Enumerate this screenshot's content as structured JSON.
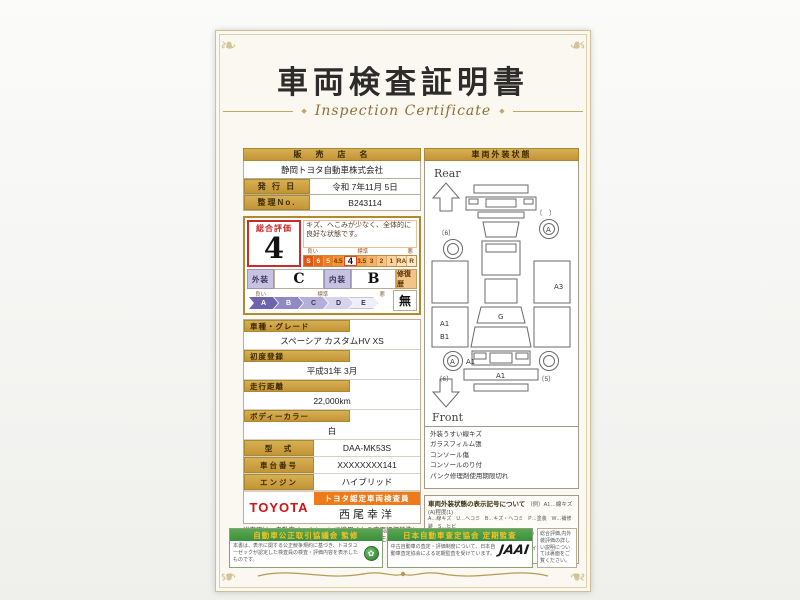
{
  "page": {
    "title": "車両検査証明書",
    "subtitle": "Inspection Certificate"
  },
  "dealer": {
    "label": "販　売　店　名",
    "value": "静岡トヨタ自動車株式会社"
  },
  "issue_date": {
    "label": "発 行 日",
    "value": "令和 7年11月 5日"
  },
  "ref_no": {
    "label": "整理No.",
    "value": "B243114"
  },
  "evaluation": {
    "overall_label": "総合評価",
    "overall_score": "4",
    "comment": "キズ、へこみが少なく、全体的に良好な状態です。",
    "scale_good": "良い",
    "scale_std": "標準",
    "scale_bad": "悪",
    "scale_cells": [
      "S",
      "6",
      "5",
      "4.5",
      "4",
      "3.5",
      "3",
      "2",
      "1",
      "RA",
      "R"
    ],
    "exterior_label": "外装",
    "exterior_value": "C",
    "interior_label": "内装",
    "interior_value": "B",
    "repair_label": "修復歴",
    "repair_value": "無",
    "grade_good": "良い",
    "grade_std": "標準",
    "grade_bad": "悪",
    "grade_cells": [
      "A",
      "B",
      "C",
      "D",
      "E"
    ]
  },
  "fields": [
    {
      "label": "車種・グレード",
      "value": "スペーシア カスタムHV XS"
    },
    {
      "label": "初度登録",
      "value": "平成31年 3月"
    },
    {
      "label": "走行距離",
      "value": "22,000km"
    },
    {
      "label": "ボディーカラー",
      "value": "白"
    },
    {
      "label": "型　式",
      "value": "DAA-MK53S"
    },
    {
      "label": "車台番号",
      "value": "XXXXXXXX141"
    },
    {
      "label": "エンジン",
      "value": "ハイブリッド"
    }
  ],
  "inspector": {
    "brand": "TOYOTA",
    "badge": "トヨタ認定車両検査員",
    "name": "西尾幸洋"
  },
  "disclaimer": "当車両は、自動車オークションで適用される車両評価基準に沿い、トヨタユーゼックが認定した検査員が厳正に検査・評価いたしました。",
  "diagram": {
    "header": "車両外装状態",
    "rear_label": "Rear",
    "front_label": "Front",
    "marks": {
      "left_a1": "A1",
      "left_b1": "B1",
      "wheel_a_right": "A",
      "wheel_a_left": "A",
      "wheel_note": "A1",
      "right_a3": "A3",
      "center_g": "G",
      "front_a1": "A1",
      "tire_tl": "〔6〕",
      "tire_tr": "〔　〕",
      "tire_bl": "〔6〕",
      "tire_br": "〔5〕"
    },
    "notes": [
      "外装うすい線キズ",
      "ガラスフィルム張",
      "コンソール傷",
      "コンソールのり付",
      "パンク修理剤使用期限切れ"
    ]
  },
  "legend": {
    "title": "車両外装状態の表示記号について",
    "example": "（例）A1…線キズ(A)程度(1)",
    "lines": [
      "A…線キズ　U…ヘコミ　B…キズ・ヘコミ　P…塗装　W…補修跡　S…ヒビ",
      "C…腐食汚れ　G…フロントガラス(飛び石キズ)　X…要交換　XX…交換済",
      "1…小程度　2…中程度　3…大程度以上　ドライヤ等の表示は取り外してあります。"
    ]
  },
  "footer": {
    "fair_trade": {
      "header": "自動車公正取引協議会 監修",
      "text": "本書は、表示に関する公正競争規約に基づき、トヨタユーゼックが認定した検査員の検査・評価内容を表示したものです。"
    },
    "jaai": {
      "header": "日本自動車査定協会 定期監査",
      "text": "中古自動車の査定・評価制度について、日本自動車査定協会による定期監査を受けています。",
      "logo": "JAAI"
    },
    "note": "総合評価,内外装評価の詳しい説明については裏面をご覧ください。"
  }
}
